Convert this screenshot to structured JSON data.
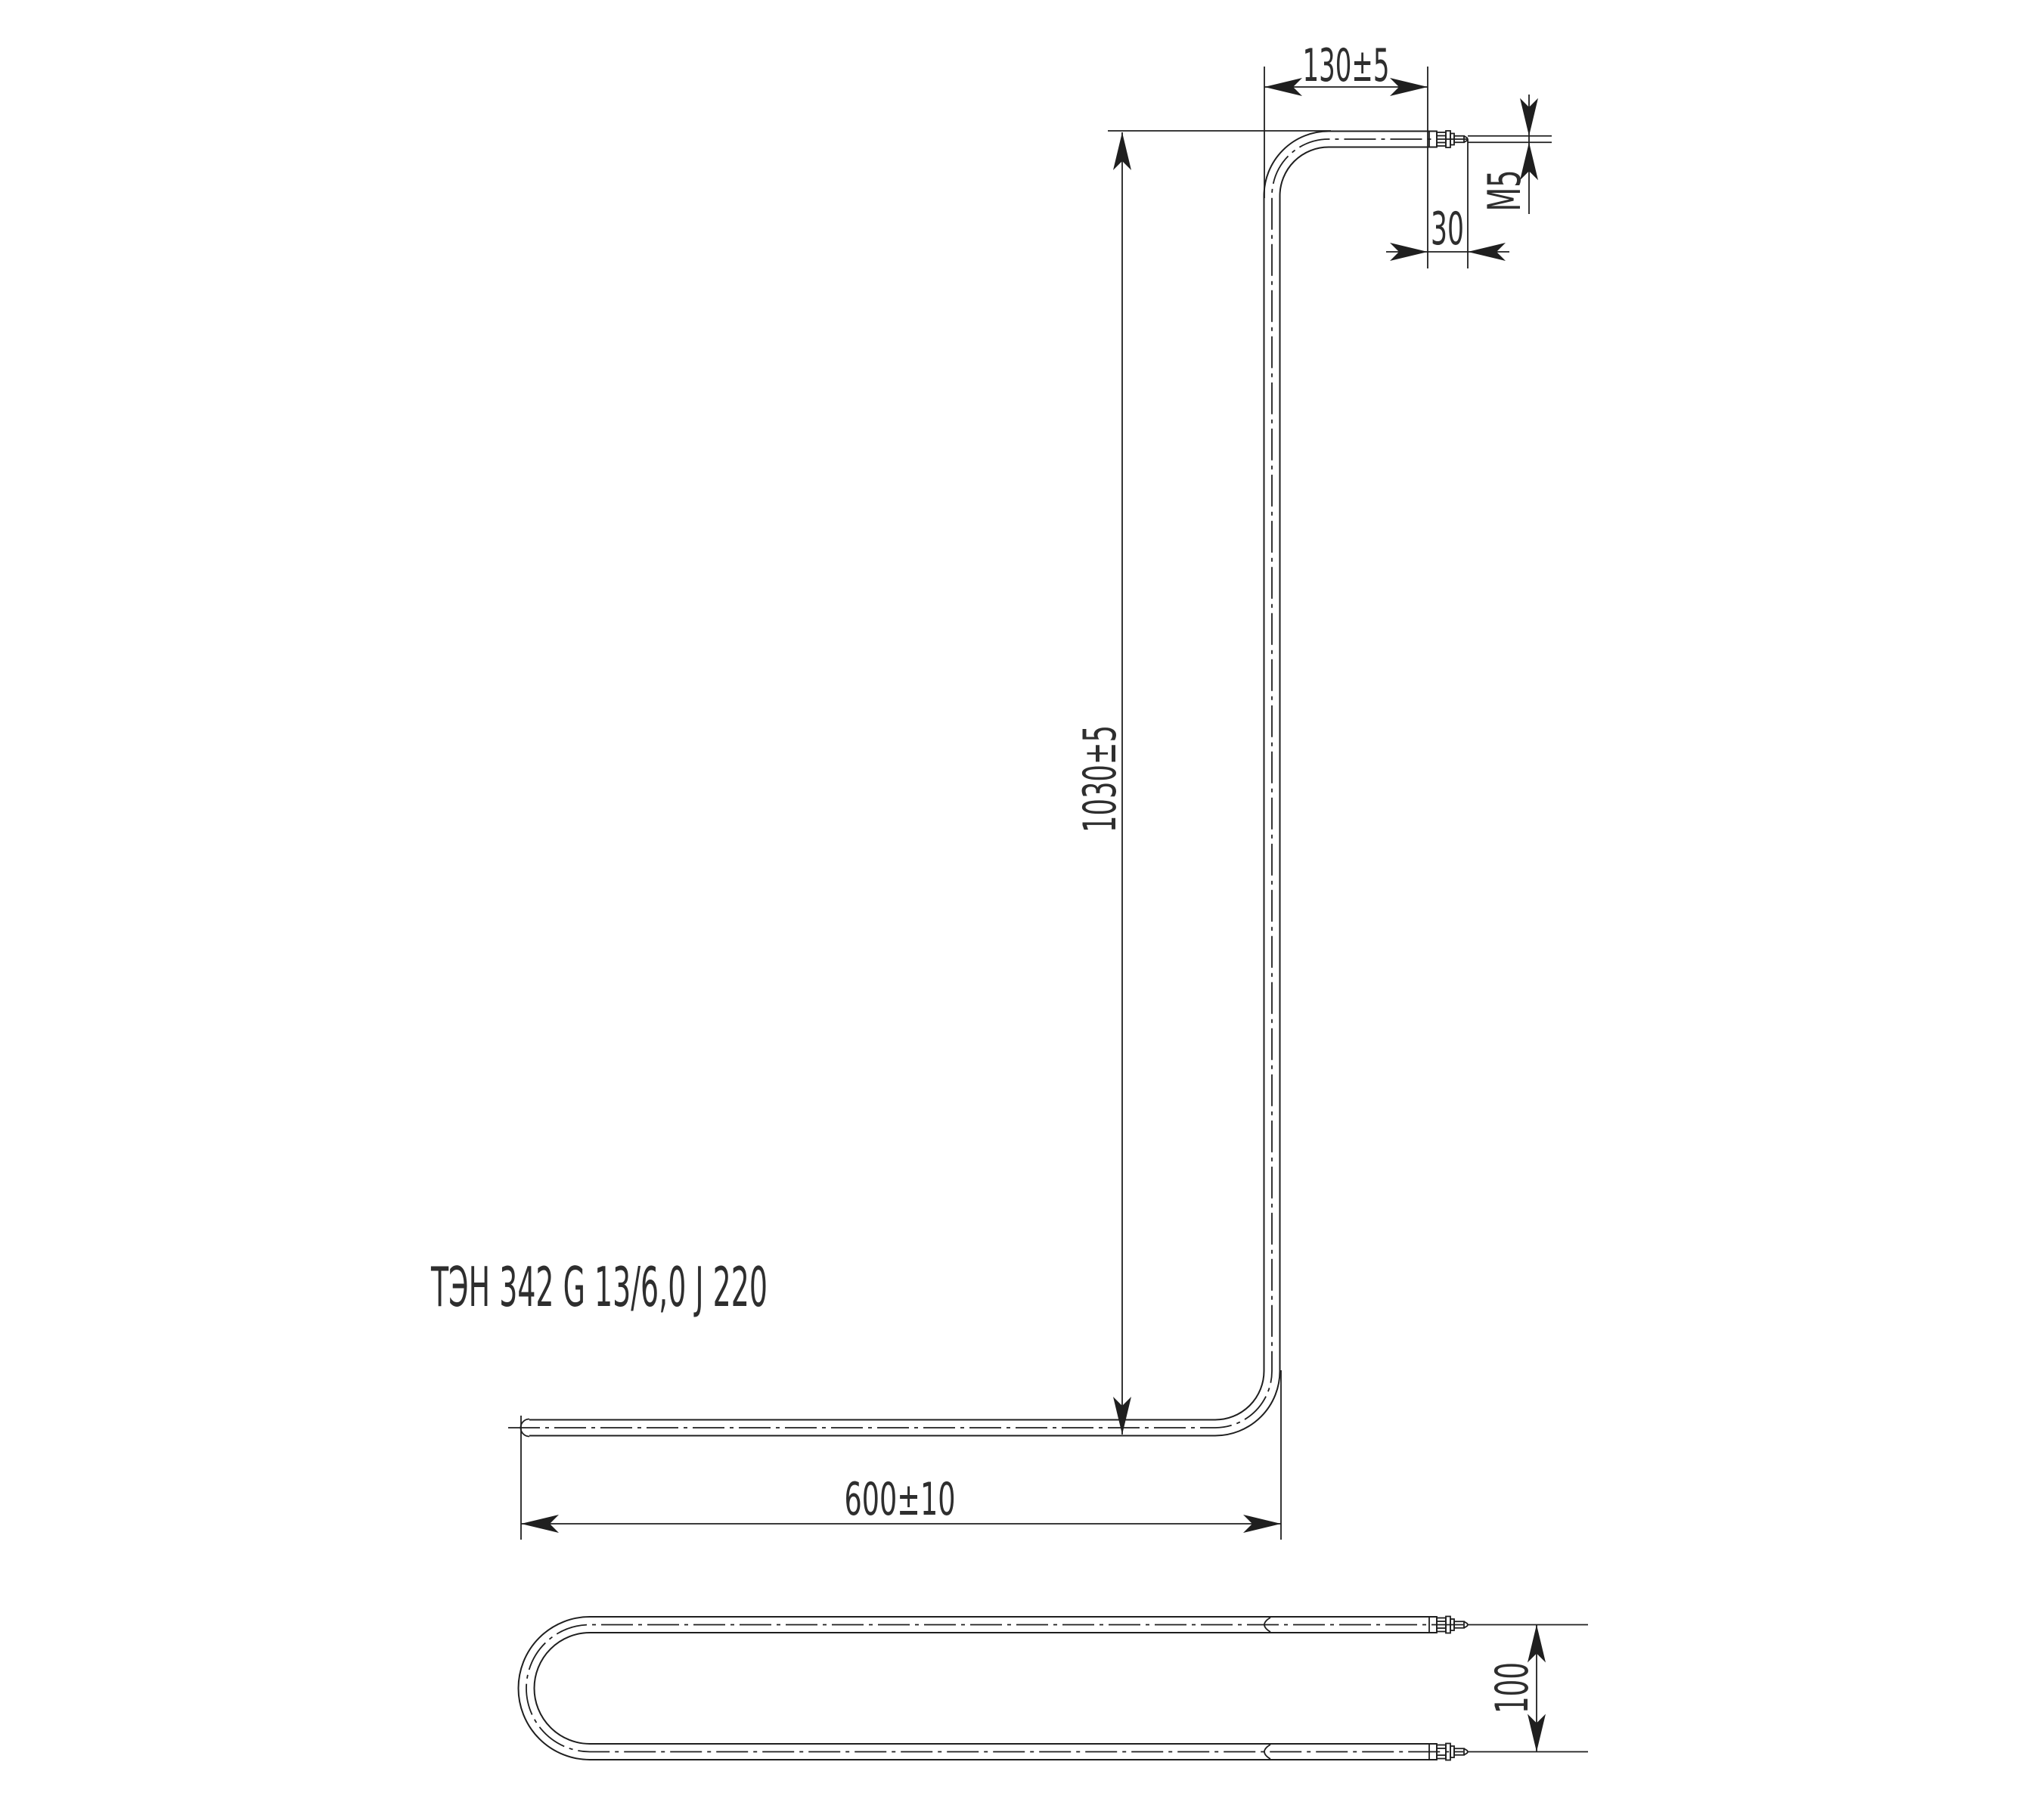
{
  "drawing": {
    "background": "#ffffff",
    "line_color": "#1f1f1f",
    "text_color": "#2e2e2e",
    "part_label": "ТЭН 342 G 13/6,0 J 220",
    "dimensions": {
      "top_arm_length": "130±5",
      "terminal_stickout": "30",
      "thread_size": "M5",
      "overall_height": "1030±5",
      "bottom_arm_length": "600±10",
      "leg_pitch": "100"
    }
  }
}
